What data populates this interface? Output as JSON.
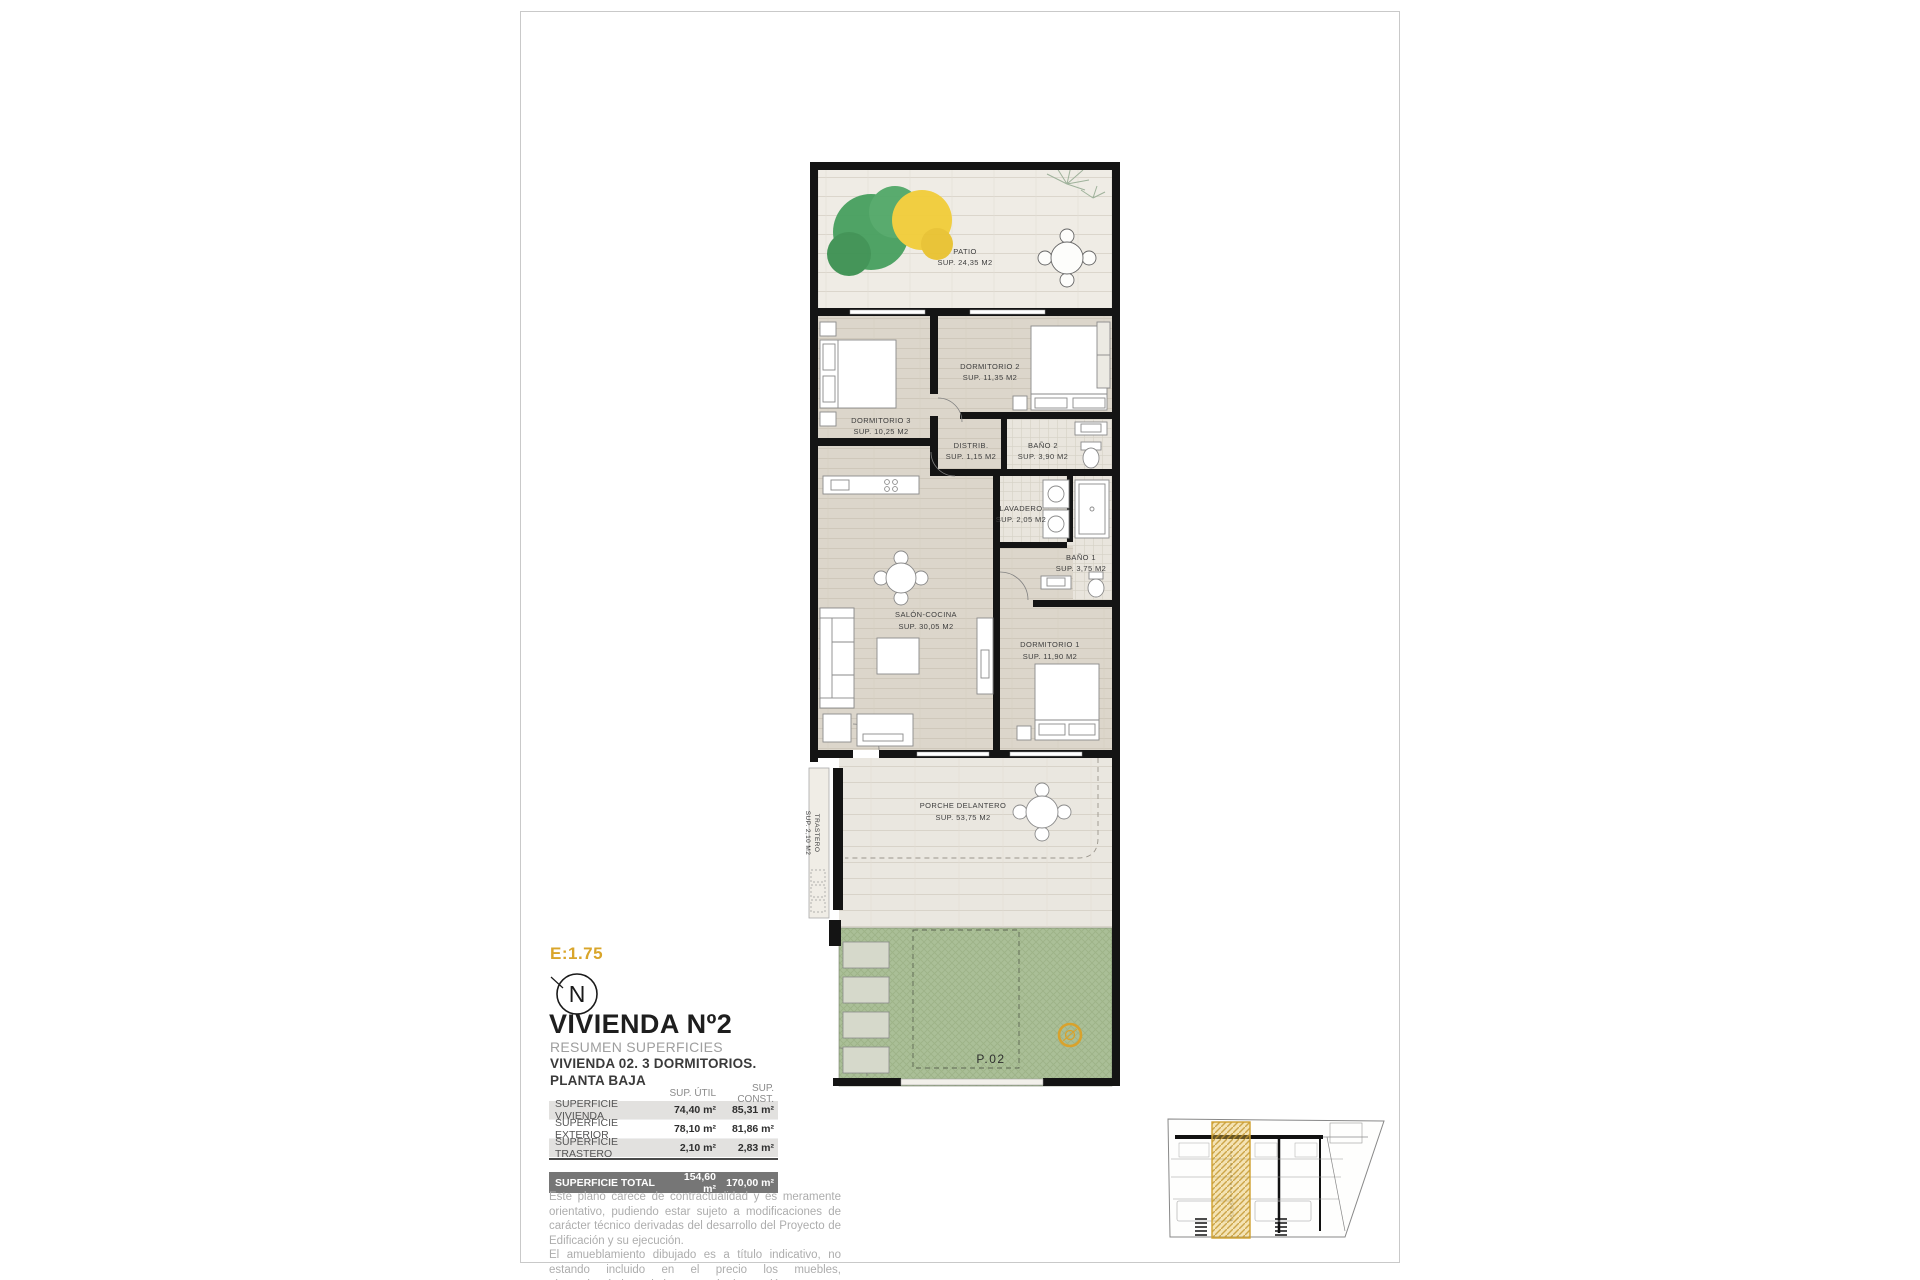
{
  "title_block": {
    "scale": "E:1.75",
    "north": "N",
    "title": "VIVIENDA Nº2",
    "subtitle": "RESUMEN SUPERFICIES",
    "line2": "VIVIENDA 02. 3 DORMITORIOS.",
    "line3": "PLANTA BAJA"
  },
  "plan": {
    "rooms": [
      {
        "name": "PATIO",
        "area": "SUP. 24,35 M2"
      },
      {
        "name": "DORMITORIO 3",
        "area": "SUP. 10,25 M2"
      },
      {
        "name": "DORMITORIO 2",
        "area": "SUP. 11,35 M2"
      },
      {
        "name": "DISTRIB.",
        "area": "SUP. 1,15 M2"
      },
      {
        "name": "BAÑO 2",
        "area": "SUP. 3,90 M2"
      },
      {
        "name": "LAVADERO",
        "area": "SUP. 2,05 M2"
      },
      {
        "name": "BAÑO 1",
        "area": "SUP. 3,75 M2"
      },
      {
        "name": "SALÓN-COCINA",
        "area": "SUP. 30,05 M2"
      },
      {
        "name": "DORMITORIO 1",
        "area": "SUP. 11,90 M2"
      },
      {
        "name": "PORCHE DELANTERO",
        "area": "SUP. 53,75 M2"
      },
      {
        "name": "TRASTERO",
        "area": "SUP. 2,10 M2"
      }
    ],
    "plot_label": "P.02"
  },
  "table": {
    "headers": {
      "util": "SUP. ÚTIL",
      "const": "SUP. CONST."
    },
    "rows": [
      {
        "label": "SUPERFICIE VIVIENDA",
        "util": "74,40 m²",
        "const": "85,31 m²"
      },
      {
        "label": "SUPERFICIE EXTERIOR",
        "util": "78,10 m²",
        "const": "81,86 m²"
      },
      {
        "label": "SUPERFICIE TRASTERO",
        "util": "2,10 m²",
        "const": "2,83 m²"
      }
    ],
    "total": {
      "label": "SUPERFICIE TOTAL",
      "util": "154,60 m²",
      "const": "170,00 m²"
    }
  },
  "disclaimer": {
    "lines": [
      "Este plano carece de contractualidad y es meramente orientativo, pudiendo estar sujeto a modificaciones de carácter técnico derivadas del desarrollo del Proyecto de Edificación y su ejecución.",
      "El amueblamiento dibujado es a título indicativo, no estando incluido en el precio los muebles, electrodomésticos ni elementos de decoración.",
      "Solo se incluye los elementos incluidos en la memoria del Proyecto visado."
    ]
  },
  "colors": {
    "accent_gold": "#d9a52a",
    "wall_black": "#141414",
    "grass_green": "#aabf97",
    "tree_green": "#47a05f",
    "tree_yellow": "#f2cd39",
    "table_total_bg": "#767676",
    "table_row_bg": "#e2e1df"
  }
}
